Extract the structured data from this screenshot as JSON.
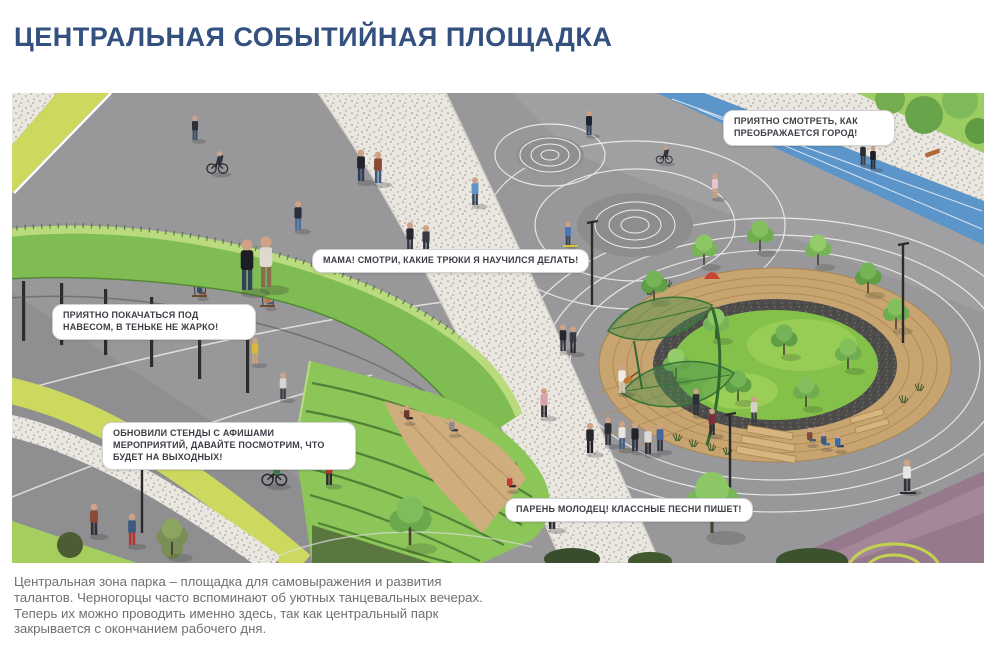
{
  "header": {
    "title": "ЦЕНТРАЛЬНАЯ СОБЫТИЙНАЯ ПЛОЩАДКА",
    "title_color": "#33507e"
  },
  "illustration": {
    "description": "Изометрическая визуализация центральной событийной площадки парка",
    "callouts": [
      {
        "id": "callout-watch-city",
        "text": "Приятно смотреть, как преображается город!"
      },
      {
        "id": "callout-tricks",
        "text": "Мама! Смотри, какие трюки я научился делать!"
      },
      {
        "id": "callout-swing",
        "text": "Приятно покачаться под навесом, в теньке не жарко!"
      },
      {
        "id": "callout-posters",
        "text": "Обновили стенды с афишами мероприятий, давайте посмотрим, что будет на выходных!"
      },
      {
        "id": "callout-songs",
        "text": "Парень молодец! Классные песни пишет!"
      }
    ],
    "colors": {
      "pavement_gray": "#98989a",
      "path_speckle": "#eae7e1",
      "bike_lane_blue": "#5b95c9",
      "path_yellow_green": "#ccd95e",
      "canopy_ramp_green": "#7fbd52",
      "lawn_green": "#84c14b",
      "wood_tan": "#c8a570",
      "gravel_dark": "#4d4c4a",
      "playground_purple": "#97798e",
      "callout_text": "#3d3d45"
    }
  },
  "caption": {
    "text": "Центральная зона парка – площадка для самовыражения и развития талантов. Черногорцы часто вспоминают об уютных танцевальных вечерах. Теперь их можно проводить именно здесь, так как центральный парк закрывается с окончанием рабочего дня."
  }
}
